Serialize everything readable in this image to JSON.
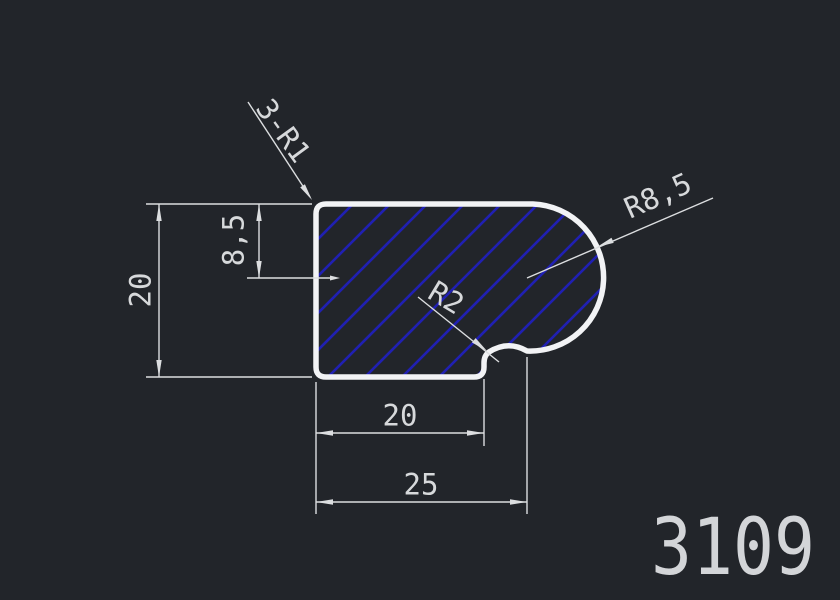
{
  "drawing": {
    "title_number": "3109",
    "dim_height": "20",
    "dim_top_offset": "8,5",
    "dim_flat_width": "20",
    "dim_total_width": "25",
    "label_fillets": "3-R1",
    "label_main_radius": "R8,5",
    "label_notch_radius": "R2",
    "colors": {
      "background": "#22252a",
      "outline": "#f2f3f5",
      "hatch_blue": "#2020b2",
      "dimension_lines": "#dcdee0",
      "text": "#d7d9db"
    }
  }
}
